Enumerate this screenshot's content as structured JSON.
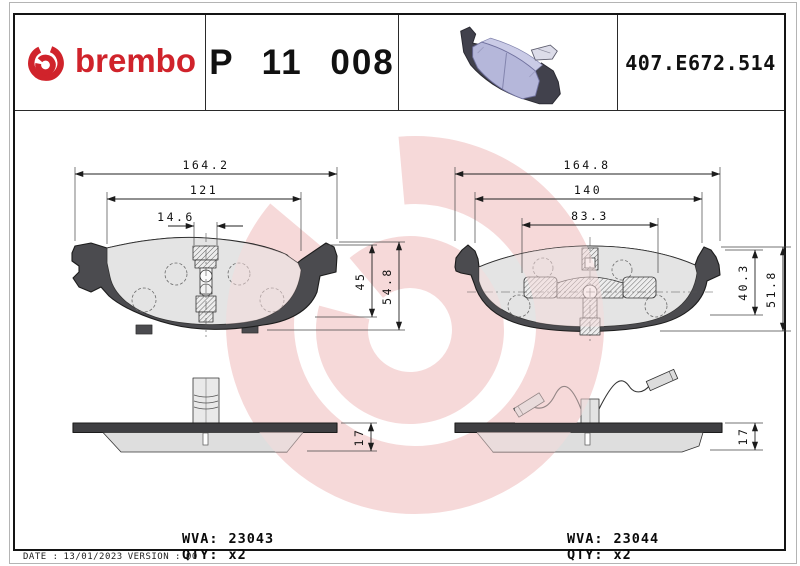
{
  "header": {
    "brand_wordmark": "brembo",
    "part_number": "P 11 008",
    "reference_code": "407.E672.514"
  },
  "drawings": {
    "left": {
      "overall_width_mm": "164.2",
      "pad_width_mm": "121",
      "clip_width_mm": "14.6",
      "pad_height_mm": "45",
      "overall_height_mm": "54.8",
      "thickness_mm": "17",
      "wva_label": "WVA:",
      "wva_number": "23043",
      "qty_label": "QTY:",
      "qty_value": "x2"
    },
    "right": {
      "overall_width_mm": "164.8",
      "pad_width_mm": "140",
      "inner_width_mm": "83.3",
      "pad_height_mm": "40.3",
      "overall_height_mm": "51.8",
      "thickness_mm": "17",
      "wva_label": "WVA:",
      "wva_number": "23044",
      "qty_label": "QTY:",
      "qty_value": "x2"
    }
  },
  "footer": {
    "date_label": "DATE :",
    "date_value": "13/01/2023",
    "version_label": "VERSION :",
    "version_value": "00"
  },
  "colors": {
    "brand_red": "#d0232b",
    "watermark_pink": "#f6d9d9",
    "pad_photo_lavender": "#b5b7da",
    "backing_plate_gray": "#4b4b4f",
    "friction_gray": "#e4e4e4"
  }
}
